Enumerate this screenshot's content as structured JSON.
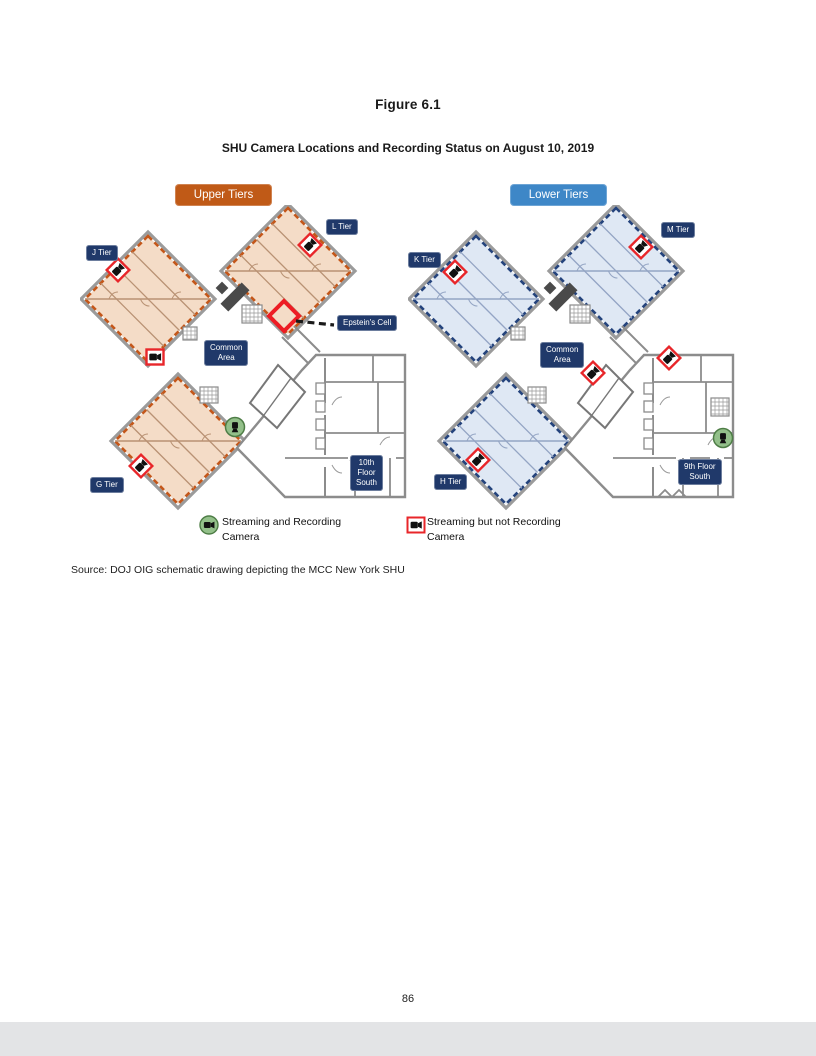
{
  "document": {
    "figure_label": "Figure 6.1",
    "figure_title": "SHU Camera Locations and Recording Status on August 10, 2019",
    "source_text": "Source:  DOJ OIG schematic drawing depicting the MCC New York SHU",
    "page_number": "86"
  },
  "legend": {
    "recording_label": "Streaming and Recording\nCamera",
    "not_recording_label": "Streaming but not Recording\nCamera",
    "recording_color": "#93c08a",
    "recording_stroke": "#4e7d46",
    "not_recording_border": "#e8262a"
  },
  "colors": {
    "label_navy": "#20396a",
    "wall_gray": "#9b9b9b",
    "elevator_gray": "#4a4a4a",
    "epstein_red": "#ed1c24"
  },
  "panels": [
    {
      "name": "upper",
      "header": "Upper Tiers",
      "header_color": "#c05a17",
      "fill": "#f4dcc7",
      "dash": "#c4571a",
      "line": "#b99274",
      "zigzag": false,
      "region_hatch": false,
      "epstein": {
        "cx": 204,
        "cy": 111,
        "r": 15,
        "line_x1": 216,
        "line_y1": 116,
        "line_x2": 254,
        "line_y2": 120
      },
      "labels": [
        {
          "name": "j-tier",
          "text": "J Tier",
          "x": 6,
          "y": 40
        },
        {
          "name": "l-tier",
          "text": "L Tier",
          "x": 246,
          "y": 14
        },
        {
          "name": "g-tier",
          "text": "G Tier",
          "x": 10,
          "y": 272
        },
        {
          "name": "common-area",
          "text": "Common\nArea",
          "x": 124,
          "y": 135
        },
        {
          "name": "epsteins-cell",
          "text": "Epstein's Cell",
          "x": 257,
          "y": 110
        },
        {
          "name": "tenth-floor-south",
          "text": "10th\nFloor\nSouth",
          "x": 270,
          "y": 250
        }
      ],
      "cameras": [
        {
          "type": "diamond",
          "x": 38,
          "y": 65
        },
        {
          "type": "diamond",
          "x": 230,
          "y": 40
        },
        {
          "type": "square",
          "x": 75,
          "y": 152
        },
        {
          "type": "diamond",
          "x": 61,
          "y": 261
        },
        {
          "type": "green",
          "x": 155,
          "y": 222
        }
      ]
    },
    {
      "name": "lower",
      "header": "Lower Tiers",
      "header_color": "#3e87c7",
      "fill": "#dfe8f4",
      "dash": "#24437c",
      "line": "#94a5c4",
      "zigzag": true,
      "region_hatch": true,
      "epstein": null,
      "labels": [
        {
          "name": "k-tier",
          "text": "K Tier",
          "x": 0,
          "y": 47
        },
        {
          "name": "m-tier",
          "text": "M Tier",
          "x": 253,
          "y": 17
        },
        {
          "name": "h-tier",
          "text": "H Tier",
          "x": 26,
          "y": 269
        },
        {
          "name": "common-area",
          "text": "Common\nArea",
          "x": 132,
          "y": 137
        },
        {
          "name": "ninth-floor-south",
          "text": "9th Floor\nSouth",
          "x": 270,
          "y": 254
        }
      ],
      "cameras": [
        {
          "type": "diamond",
          "x": 47,
          "y": 67
        },
        {
          "type": "diamond",
          "x": 233,
          "y": 42
        },
        {
          "type": "diamond",
          "x": 185,
          "y": 168
        },
        {
          "type": "diamond",
          "x": 261,
          "y": 153
        },
        {
          "type": "diamond",
          "x": 70,
          "y": 255
        },
        {
          "type": "green",
          "x": 315,
          "y": 233
        }
      ]
    }
  ]
}
